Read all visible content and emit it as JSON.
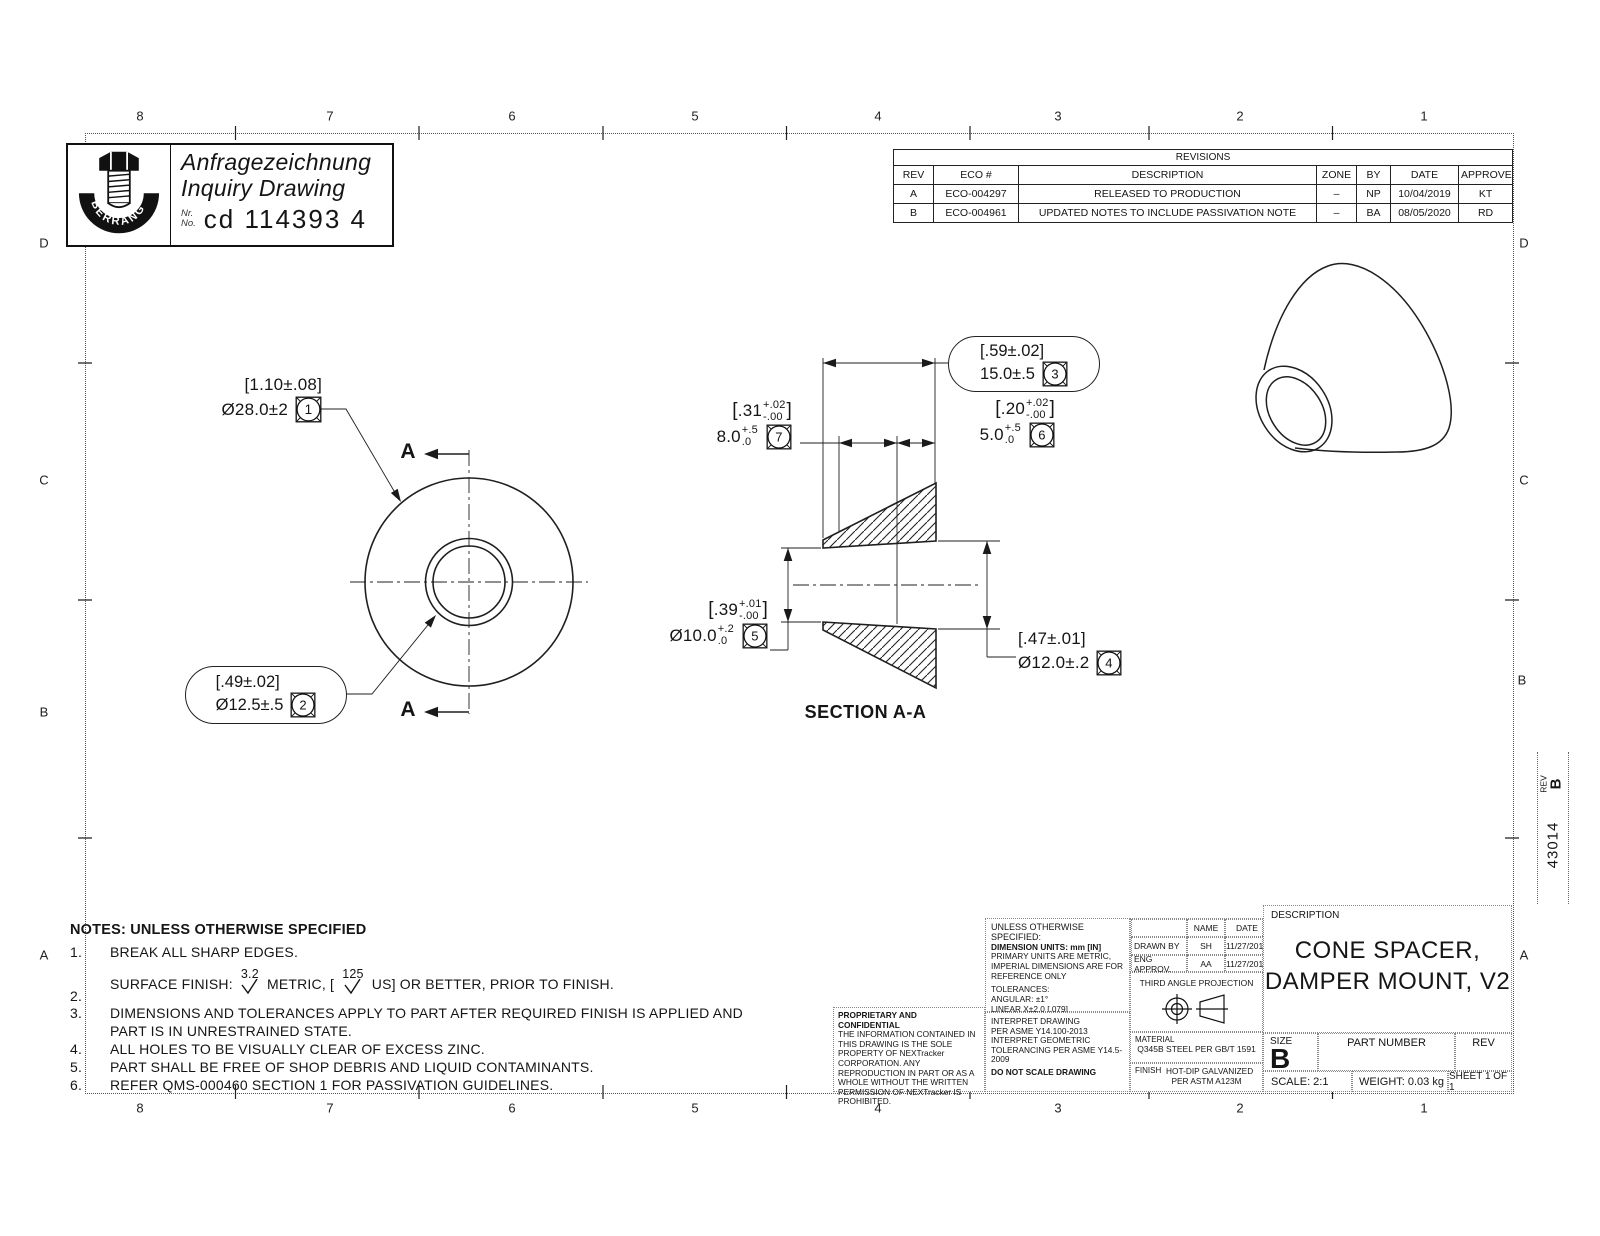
{
  "zones": {
    "top": [
      "8",
      "7",
      "6",
      "5",
      "4",
      "3",
      "2",
      "1"
    ],
    "bottom": [
      "8",
      "7",
      "6",
      "5",
      "4",
      "3",
      "2",
      "1"
    ],
    "left": [
      "D",
      "C",
      "B",
      "A"
    ],
    "right": [
      "D",
      "C",
      "B",
      "A"
    ]
  },
  "margin": {
    "rev_label": "REV",
    "rev_value": "B",
    "doc_number": "43014"
  },
  "inquiry": {
    "brand": "BERRANG",
    "title_de": "Anfragezeichnung",
    "title_en": "Inquiry Drawing",
    "nr_label": "Nr.",
    "no_label": "No.",
    "number": "cd 114393 4"
  },
  "revisions": {
    "title": "REVISIONS",
    "headers": [
      "REV",
      "ECO #",
      "DESCRIPTION",
      "ZONE",
      "BY",
      "DATE",
      "APPROVED"
    ],
    "rows": [
      [
        "A",
        "ECO-004297",
        "RELEASED TO PRODUCTION",
        "–",
        "NP",
        "10/04/2019",
        "KT"
      ],
      [
        "B",
        "ECO-004961",
        "UPDATED NOTES TO INCLUDE PASSIVATION NOTE",
        "–",
        "BA",
        "08/05/2020",
        "RD"
      ]
    ]
  },
  "views": {
    "section_label": "SECTION A-A",
    "cut_letter": "A"
  },
  "callouts": {
    "c1": {
      "imperial": "[1.10±.08]",
      "metric": "Ø28.0±2",
      "flag": "1"
    },
    "c2": {
      "imperial": "[.49±.02]",
      "metric": "Ø12.5±.5",
      "flag": "2"
    },
    "c3": {
      "imperial": "[.59±.02]",
      "metric": "15.0±.5",
      "flag": "3"
    },
    "c4": {
      "imperial": "[.47±.01]",
      "metric": "Ø12.0±.2",
      "flag": "4"
    },
    "c5": {
      "imp_open": "[",
      "imp_base": ".39",
      "imp_plus": "+.01",
      "imp_minus": "-.00",
      "imp_close": "]",
      "met_base": "Ø10.0",
      "met_plus": "+.2",
      "met_minus": ".0",
      "flag": "5"
    },
    "c6": {
      "imp_open": "[",
      "imp_base": ".20",
      "imp_plus": "+.02",
      "imp_minus": "-.00",
      "imp_close": "]",
      "met_base": "5.0",
      "met_plus": "+.5",
      "met_minus": ".0",
      "flag": "6"
    },
    "c7": {
      "imp_open": "[",
      "imp_base": ".31",
      "imp_plus": "+.02",
      "imp_minus": "-.00",
      "imp_close": "]",
      "met_base": "8.0",
      "met_plus": "+.5",
      "met_minus": ".0",
      "flag": "7"
    }
  },
  "notes": {
    "title": "NOTES: UNLESS OTHERWISE SPECIFIED",
    "item1_num": "1.",
    "item1": "BREAK ALL SHARP EDGES.",
    "item2_num": "2.",
    "item2_pre": "SURFACE FINISH:",
    "item2_sym1": "3.2",
    "item2_mid": "METRIC, [",
    "item2_sym2": "125",
    "item2_post": "US] OR BETTER, PRIOR TO FINISH.",
    "item3_num": "3.",
    "item3": "DIMENSIONS AND TOLERANCES APPLY TO PART AFTER REQUIRED FINISH IS APPLIED AND PART IS IN UNRESTRAINED STATE.",
    "item4_num": "4.",
    "item4": "ALL HOLES TO BE VISUALLY CLEAR OF EXCESS ZINC.",
    "item5_num": "5.",
    "item5": "PART SHALL BE FREE OF SHOP DEBRIS AND LIQUID CONTAMINANTS.",
    "item6_num": "6.",
    "item6": "REFER QMS-000460 SECTION 1 FOR PASSIVATION GUIDELINES."
  },
  "title_block": {
    "proprietary_title": "PROPRIETARY AND CONFIDENTIAL",
    "proprietary_body": "THE INFORMATION CONTAINED IN THIS DRAWING IS THE SOLE PROPERTY OF NEXTracker CORPORATION.  ANY REPRODUCTION IN PART OR AS A WHOLE WITHOUT THE WRITTEN PERMISSION OF NEXTracker IS PROHIBITED.",
    "uos_title": "UNLESS OTHERWISE SPECIFIED:",
    "units_line": "DIMENSION UNITS: mm [IN]",
    "units_note": "PRIMARY UNITS ARE METRIC,\nIMPERIAL DIMENSIONS ARE FOR\nREFERENCE ONLY",
    "tolerances": "TOLERANCES:\nANGULAR:  ±1°\nLINEAR      X±2.0    [.079]\nLINEAR     .X±1.2    [.047]\nLINEAR    .XX±0.50  [.020]",
    "interpret": "INTERPRET DRAWING\nPER ASME Y14.100-2013\nINTERPRET GEOMETRIC\nTOLERANCING PER ASME Y14.5-2009",
    "do_not_scale": "DO NOT SCALE DRAWING",
    "name_header": "NAME",
    "date_header": "DATE",
    "drawn_label": "DRAWN BY",
    "drawn_name": "SH",
    "drawn_date": "11/27/2018",
    "eng_label": "ENG APPROV.",
    "eng_name": "AA",
    "eng_date": "11/27/2018",
    "projection_label": "THIRD ANGLE PROJECTION",
    "material_label": "MATERIAL",
    "material_value": "Q345B STEEL PER GB/T 1591",
    "finish_label": "FINISH",
    "finish_value": "HOT-DIP GALVANIZED\nPER ASTM A123M",
    "description_label": "DESCRIPTION",
    "description_line1": "CONE SPACER,",
    "description_line2": "DAMPER MOUNT, V2",
    "size_label": "SIZE",
    "size_value": "B",
    "part_number_label": "PART NUMBER",
    "rev_label": "REV",
    "scale": "SCALE: 2:1",
    "weight": "WEIGHT: 0.03 kg",
    "sheet": "SHEET 1 OF 1"
  }
}
